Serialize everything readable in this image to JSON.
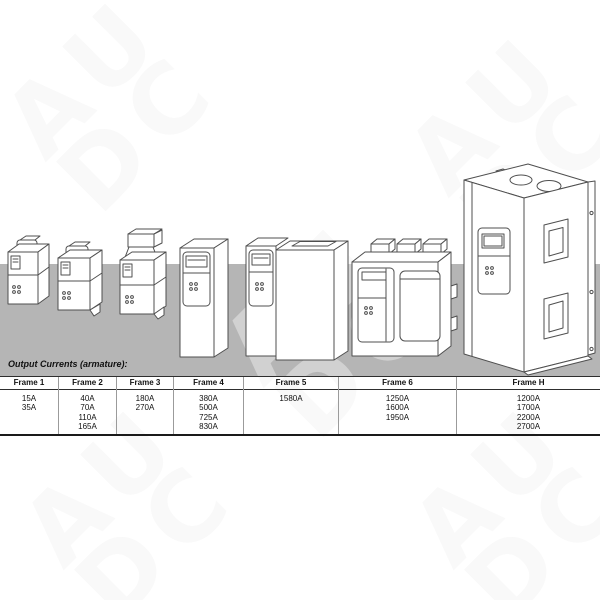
{
  "watermark": {
    "line1": "AU",
    "line2": "DC"
  },
  "caption": "Output Currents (armature):",
  "chart_data": {
    "type": "table",
    "title": "Output Currents (armature):",
    "columns": [
      "Frame 1",
      "Frame 2",
      "Frame 3",
      "Frame 4",
      "Frame 5",
      "Frame 6",
      "Frame H"
    ],
    "values": [
      [
        "15A",
        "35A"
      ],
      [
        "40A",
        "70A",
        "110A",
        "165A"
      ],
      [
        "180A",
        "270A"
      ],
      [
        "380A",
        "500A",
        "725A",
        "830A"
      ],
      [
        "1580A"
      ],
      [
        "1250A",
        "1600A",
        "1950A"
      ],
      [
        "1200A",
        "1700A",
        "2200A",
        "2700A"
      ]
    ]
  },
  "drawings": [
    "frame-1-drive-unit",
    "frame-2-drive-unit",
    "frame-3-drive-unit",
    "frame-4-drive-unit",
    "frame-5-drive-unit",
    "frame-6-drive-unit",
    "frame-h-drive-cabinet"
  ],
  "colors": {
    "ground_band": "#b5b5b5",
    "line_art": "#4f4f4f",
    "table_border": "#2e2e2e",
    "text": "#111111",
    "watermark": "#f5f5f5"
  }
}
